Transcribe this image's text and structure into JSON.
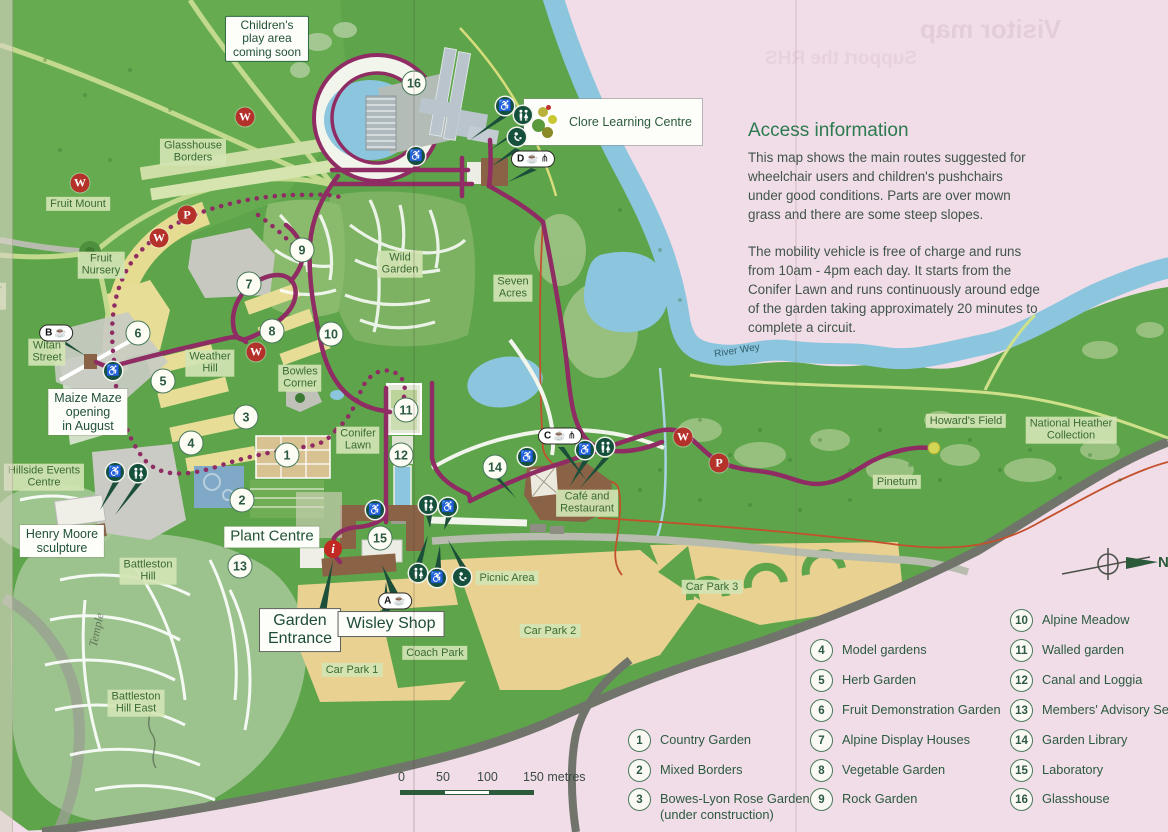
{
  "bleed": {
    "line1": "Visitor map",
    "line2": "Support the RHS"
  },
  "access_info": {
    "heading": "Access information",
    "para1": "This map shows the main routes suggested for wheelchair users and children's pushchairs under good conditions. Parts are over mown grass and there are some steep slopes.",
    "para2": "The mobility vehicle is free of charge and runs from 10am - 4pm each day. It starts from the Conifer Lawn and runs continuously around edge of the garden taking approximately 20 minutes to complete a circuit."
  },
  "compass": {
    "north": "N"
  },
  "map": {
    "scale": {
      "ticks": [
        "0",
        "50",
        "100",
        "150 metres"
      ]
    },
    "labels": [
      {
        "id": "childrens-play-area",
        "st": "gbox",
        "x": 267,
        "y": 39,
        "ln": [
          "Children's",
          "play area",
          "coming soon"
        ]
      },
      {
        "id": "glasshouse-borders",
        "st": "area",
        "x": 193,
        "y": 152,
        "ln": [
          "Glasshouse",
          "Borders"
        ]
      },
      {
        "id": "fruit-mount",
        "st": "area",
        "x": 78,
        "y": 204,
        "ln": [
          "Fruit Mount"
        ]
      },
      {
        "id": "fruit-nursery",
        "st": "area",
        "x": 101,
        "y": 265,
        "ln": [
          "Fruit",
          "Nursery"
        ]
      },
      {
        "id": "edge-partial",
        "st": "area",
        "x": -6,
        "y": 296,
        "ln": [
          "her",
          "on"
        ]
      },
      {
        "id": "witan-street",
        "st": "area",
        "x": 47,
        "y": 352,
        "ln": [
          "Witan",
          "Street"
        ]
      },
      {
        "id": "weather-hill",
        "st": "area",
        "x": 210,
        "y": 363,
        "ln": [
          "Weather",
          "Hill"
        ]
      },
      {
        "id": "bowles-corner",
        "st": "area",
        "x": 300,
        "y": 378,
        "ln": [
          "Bowles",
          "Corner"
        ]
      },
      {
        "id": "wild-garden",
        "st": "area",
        "x": 400,
        "y": 264,
        "ln": [
          "Wild",
          "Garden"
        ]
      },
      {
        "id": "seven-acres",
        "st": "area",
        "x": 513,
        "y": 288,
        "ln": [
          "Seven",
          "Acres"
        ]
      },
      {
        "id": "conifer-lawn",
        "st": "area",
        "x": 358,
        "y": 440,
        "ln": [
          "Conifer",
          "Lawn"
        ]
      },
      {
        "id": "maize-maze",
        "st": "white",
        "x": 88,
        "y": 412,
        "ln": [
          "Maize Maze",
          "opening",
          "in August"
        ]
      },
      {
        "id": "hillside-events-centre",
        "st": "area",
        "x": 44,
        "y": 477,
        "ln": [
          "Hillside Events",
          "Centre"
        ]
      },
      {
        "id": "henry-moore",
        "st": "white",
        "x": 62,
        "y": 541,
        "ln": [
          "Henry Moore",
          "sculpture"
        ]
      },
      {
        "id": "plant-centre",
        "st": "white",
        "x": 272,
        "y": 537,
        "fs": 15,
        "ln": [
          "Plant Centre"
        ]
      },
      {
        "id": "battleston-hill",
        "st": "area",
        "x": 148,
        "y": 571,
        "ln": [
          "Battleston",
          "Hill"
        ]
      },
      {
        "id": "battleston-hill-east",
        "st": "area",
        "x": 136,
        "y": 703,
        "ln": [
          "Battleston",
          "Hill East"
        ]
      },
      {
        "id": "garden-entrance",
        "st": "wbox",
        "x": 300,
        "y": 630,
        "ln": [
          "Garden",
          "Entrance"
        ]
      },
      {
        "id": "wisley-shop",
        "st": "wbox",
        "x": 391,
        "y": 624,
        "ln": [
          "Wisley Shop"
        ]
      },
      {
        "id": "car-park-1",
        "st": "area",
        "x": 352,
        "y": 670,
        "ln": [
          "Car Park 1"
        ]
      },
      {
        "id": "coach-park",
        "st": "area",
        "x": 435,
        "y": 653,
        "ln": [
          "Coach Park"
        ]
      },
      {
        "id": "car-park-2",
        "st": "area",
        "x": 550,
        "y": 631,
        "ln": [
          "Car Park 2"
        ]
      },
      {
        "id": "picnic-area",
        "st": "area",
        "x": 507,
        "y": 578,
        "ln": [
          "Picnic Area"
        ]
      },
      {
        "id": "car-park-3",
        "st": "area",
        "x": 712,
        "y": 587,
        "ln": [
          "Car Park 3"
        ]
      },
      {
        "id": "cafe-and-restaurant",
        "st": "area",
        "x": 587,
        "y": 503,
        "ln": [
          "Café and",
          "Restaurant"
        ]
      },
      {
        "id": "pinetum",
        "st": "area",
        "x": 897,
        "y": 482,
        "ln": [
          "Pinetum"
        ]
      },
      {
        "id": "howards-field",
        "st": "area",
        "x": 966,
        "y": 421,
        "ln": [
          "Howard's Field"
        ]
      },
      {
        "id": "national-heather-collection",
        "st": "area",
        "x": 1071,
        "y": 430,
        "ln": [
          "National Heather",
          "Collection"
        ]
      },
      {
        "id": "river-wey",
        "st": "plain",
        "x": 737,
        "y": 351,
        "rot": -9,
        "ln": [
          "River Wey"
        ]
      },
      {
        "id": "clore-learning-centre",
        "st": "clore",
        "x": 613,
        "y": 122,
        "ln": [
          "Clore Learning Centre"
        ]
      },
      {
        "id": "handwriting-temple",
        "st": "hand",
        "x": 97,
        "y": 630,
        "rot": -78,
        "ln": [
          "Temple"
        ]
      }
    ],
    "numbered_markers": [
      {
        "n": "1",
        "x": 287,
        "y": 455
      },
      {
        "n": "2",
        "x": 242,
        "y": 500
      },
      {
        "n": "3",
        "x": 246,
        "y": 417
      },
      {
        "n": "4",
        "x": 191,
        "y": 443
      },
      {
        "n": "5",
        "x": 163,
        "y": 381
      },
      {
        "n": "6",
        "x": 138,
        "y": 333
      },
      {
        "n": "7",
        "x": 249,
        "y": 284
      },
      {
        "n": "8",
        "x": 272,
        "y": 331
      },
      {
        "n": "9",
        "x": 302,
        "y": 250
      },
      {
        "n": "10",
        "x": 331,
        "y": 334
      },
      {
        "n": "11",
        "x": 406,
        "y": 410
      },
      {
        "n": "12",
        "x": 401,
        "y": 455
      },
      {
        "n": "13",
        "x": 240,
        "y": 566
      },
      {
        "n": "14",
        "x": 495,
        "y": 467
      },
      {
        "n": "15",
        "x": 380,
        "y": 538
      },
      {
        "n": "16",
        "x": 414,
        "y": 83
      }
    ],
    "letter_markers": [
      {
        "l": "W",
        "x": 245,
        "y": 117
      },
      {
        "l": "W",
        "x": 80,
        "y": 183
      },
      {
        "l": "W",
        "x": 159,
        "y": 238
      },
      {
        "l": "W",
        "x": 256,
        "y": 352
      },
      {
        "l": "W",
        "x": 683,
        "y": 437
      },
      {
        "l": "P",
        "x": 187,
        "y": 215
      },
      {
        "l": "P",
        "x": 719,
        "y": 463
      }
    ],
    "facilities": [
      {
        "t": "wheelchair",
        "x": 505,
        "y": 106
      },
      {
        "t": "toilets",
        "x": 523,
        "y": 115
      },
      {
        "t": "baby",
        "x": 517,
        "y": 137
      },
      {
        "t": "wheelchair",
        "x": 416,
        "y": 156
      },
      {
        "t": "wheelchair",
        "x": 113,
        "y": 371
      },
      {
        "t": "wheelchair",
        "x": 115,
        "y": 472
      },
      {
        "t": "toilets",
        "x": 138,
        "y": 473
      },
      {
        "t": "wheelchair",
        "x": 375,
        "y": 510
      },
      {
        "t": "toilets",
        "x": 428,
        "y": 505
      },
      {
        "t": "wheelchair",
        "x": 448,
        "y": 507
      },
      {
        "t": "toilets",
        "x": 418,
        "y": 573
      },
      {
        "t": "wheelchair",
        "x": 437,
        "y": 578
      },
      {
        "t": "baby",
        "x": 462,
        "y": 577
      },
      {
        "t": "wheelchair",
        "x": 527,
        "y": 457
      },
      {
        "t": "wheelchair",
        "x": 585,
        "y": 450
      },
      {
        "t": "toilets",
        "x": 605,
        "y": 447
      }
    ],
    "badges": [
      {
        "letter": "A",
        "x": 395,
        "y": 601,
        "fork": false
      },
      {
        "letter": "B",
        "x": 56,
        "y": 333,
        "fork": false
      },
      {
        "letter": "C",
        "x": 560,
        "y": 436,
        "fork": true
      },
      {
        "letter": "D",
        "x": 533,
        "y": 159,
        "fork": true
      }
    ],
    "info_marker": {
      "glyph": "i",
      "x": 333,
      "y": 549
    },
    "endpoint_dot": {
      "x": 934,
      "y": 448
    }
  },
  "legend": {
    "columns": [
      {
        "x": 628,
        "items": [
          {
            "num": "1",
            "label": "Country Garden",
            "y": 729
          },
          {
            "num": "2",
            "label": "Mixed Borders",
            "y": 759
          },
          {
            "num": "3",
            "label": "Bowes-Lyon Rose Garden",
            "label2": "(under construction)",
            "y": 788
          }
        ]
      },
      {
        "x": 810,
        "items": [
          {
            "num": "4",
            "label": "Model gardens",
            "y": 639
          },
          {
            "num": "5",
            "label": "Herb Garden",
            "y": 669
          },
          {
            "num": "6",
            "label": "Fruit Demonstration Garden",
            "y": 699
          },
          {
            "num": "7",
            "label": "Alpine Display Houses",
            "y": 729
          },
          {
            "num": "8",
            "label": "Vegetable Garden",
            "y": 759
          },
          {
            "num": "9",
            "label": "Rock Garden",
            "y": 788
          }
        ]
      },
      {
        "x": 1010,
        "items": [
          {
            "num": "10",
            "label": "Alpine Meadow",
            "y": 609
          },
          {
            "num": "11",
            "label": "Walled garden",
            "y": 639
          },
          {
            "num": "12",
            "label": "Canal and Loggia",
            "y": 669
          },
          {
            "num": "13",
            "label": "Members' Advisory Service",
            "y": 699
          },
          {
            "num": "14",
            "label": "Garden Library",
            "y": 729
          },
          {
            "num": "15",
            "label": "Laboratory",
            "y": 759
          },
          {
            "num": "16",
            "label": "Glasshouse",
            "y": 788
          }
        ]
      }
    ]
  },
  "colors": {
    "paper_pink": "#f1dde8",
    "green_main": "#5ea44b",
    "water": "#8cc5de",
    "car_park_tan": "#e9d192",
    "route_purple": "#8e2c63",
    "badge_red": "#b5322b",
    "icon_green": "#14503c",
    "road_dark": "#70746b",
    "label_green_text": "#3a6a33",
    "heading_green": "#2c7a50",
    "boundary_red": "#c2512c"
  }
}
